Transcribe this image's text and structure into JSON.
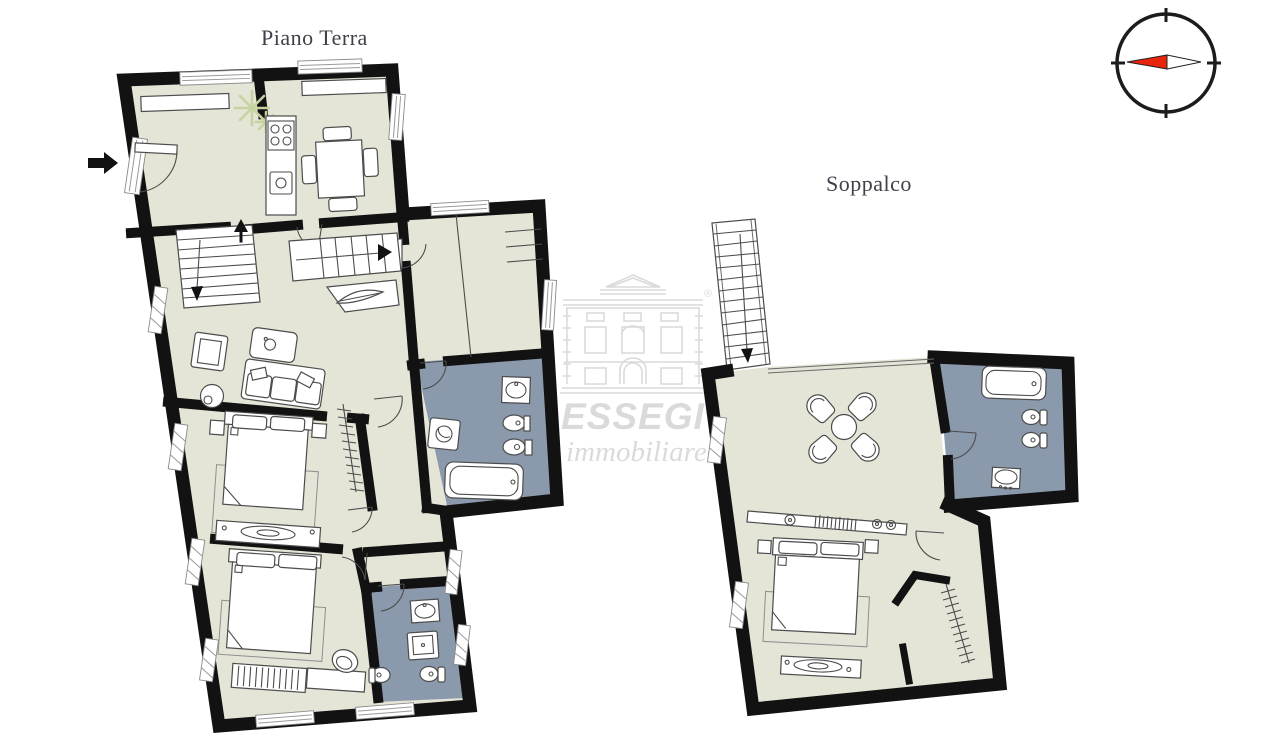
{
  "page": {
    "background": "#ffffff"
  },
  "titles": {
    "ground_floor": "Piano Terra",
    "mezzanine": "Soppalco"
  },
  "watermark": {
    "brand": "ESSEGI",
    "subtitle": "immobiliare",
    "registered": "®"
  },
  "compass": {
    "needle_direction": "west"
  },
  "colors": {
    "pagebg": "#ffffff",
    "floor": "#e4e4d7",
    "bath": "#8b99ad",
    "wall": "#121212",
    "title": "#40404a",
    "watermark": "#dadada",
    "needle_red": "#e8230e",
    "plant": "#c5d49e"
  },
  "plans": [
    {
      "title": "Piano Terra",
      "elements": [
        "entrance",
        "kitchen-dining",
        "living-room",
        "staircase-down",
        "staircase-up",
        "hallway-closet",
        "main-bathroom",
        "corridor",
        "bedroom-1",
        "bedroom-2",
        "second-bathroom"
      ]
    },
    {
      "title": "Soppalco",
      "elements": [
        "staircase",
        "open-living-area",
        "round-table-with-4-chairs",
        "bathroom",
        "bedroom",
        "walk-in-closet"
      ]
    }
  ]
}
